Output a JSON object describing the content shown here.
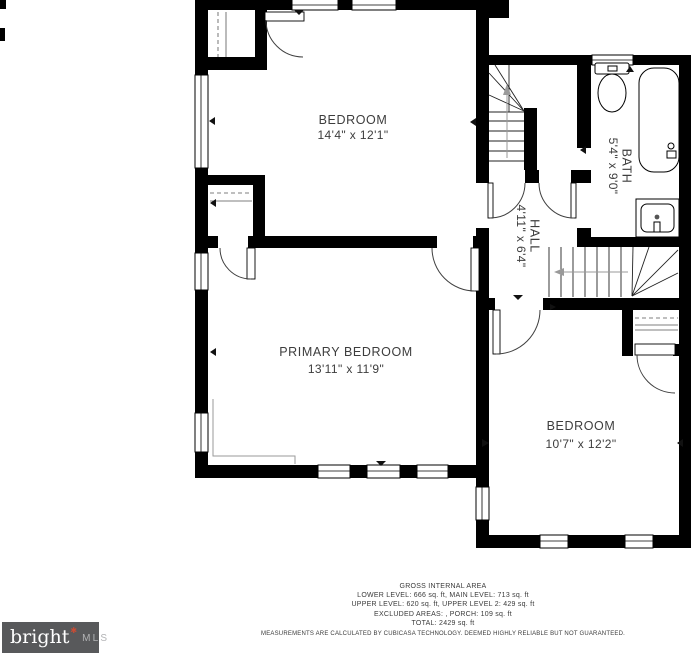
{
  "plan": {
    "rooms": [
      {
        "id": "bedroom-top",
        "name": "BEDROOM",
        "dims": "14'4\" x 12'1\""
      },
      {
        "id": "primary-bedroom",
        "name": "PRIMARY BEDROOM",
        "dims": "13'11\" x 11'9\""
      },
      {
        "id": "bedroom-right",
        "name": "BEDROOM",
        "dims": "10'7\" x 12'2\""
      },
      {
        "id": "hall",
        "name": "HALL",
        "dims": "4'11\" x 6'4\""
      },
      {
        "id": "bath",
        "name": "BATH",
        "dims": "5'4\" x 9'0\""
      }
    ]
  },
  "footer": {
    "title": "GROSS INTERNAL AREA",
    "line1": "LOWER LEVEL: 666 sq. ft, MAIN LEVEL: 713 sq. ft",
    "line2": "UPPER LEVEL: 620 sq. ft, UPPER LEVEL 2: 429 sq. ft",
    "line3": "EXCLUDED AREAS: , PORCH: 109 sq. ft",
    "line4": "TOTAL: 2429 sq. ft",
    "disclaimer": "MEASUREMENTS ARE CALCULATED BY CUBICASA TECHNOLOGY. DEEMED HIGHLY RELIABLE BUT NOT GUARANTEED."
  },
  "logo": {
    "brand": "bright",
    "star": "✱",
    "suffix": "MLS",
    "background": "#58595b",
    "star_color": "#cc4b33"
  },
  "colors": {
    "wall": "#000000",
    "label_text": "#3d3d3d",
    "footer_text": "#3b3b3b"
  }
}
